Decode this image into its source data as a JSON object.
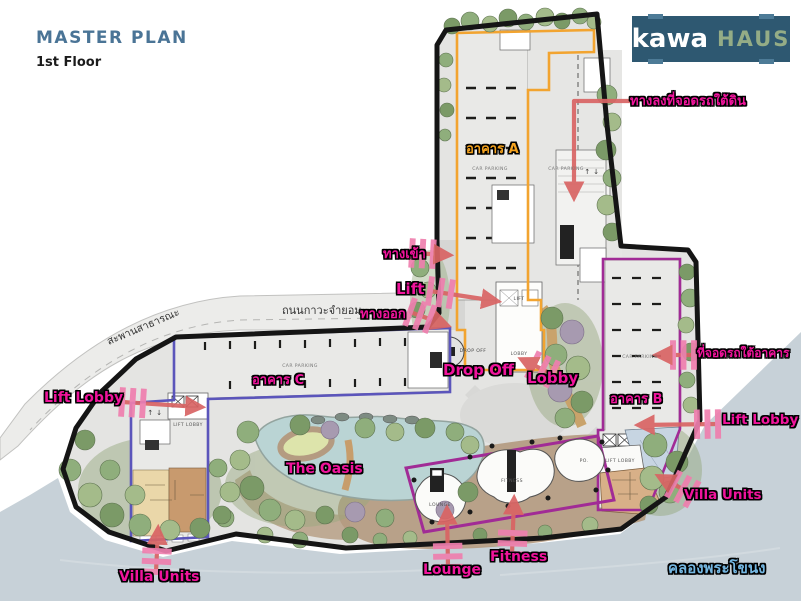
{
  "header": {
    "title": "MASTER PLAN",
    "subtitle": "1st Floor"
  },
  "logo": {
    "word1": "kawa",
    "word2": "HAUS"
  },
  "callouts": {
    "underground_ramp": "ทางลงที่จอดรถใต้ดิน",
    "entrance": "ทางเข้า",
    "lift": "Lift",
    "exit": "ทางออก",
    "drop_off": "Drop Off",
    "lobby": "Lobby",
    "building_a": "อาคาร A",
    "building_b": "อาคาร B",
    "building_c": "อาคาร C",
    "lift_lobby_left": "Lift Lobby",
    "lift_lobby_right": "Lift Lobby",
    "parking_under_building": "ที่จอดรถใต้อาคาร",
    "villa_units_left": "Villa Units",
    "villa_units_right": "Villa Units",
    "the_oasis": "The Oasis",
    "lounge": "Lounge",
    "fitness": "Fitness",
    "canal": "คลองพระโขนง",
    "road": "ถนนกาวะจำยอม",
    "bridge": "สะพานสาธารณะ"
  },
  "plan_texts": {
    "car_parking": "CAR PARKING",
    "drop_off": "DROP OFF",
    "lobby": "LOBBY",
    "lift": "LIFT",
    "lift_lobby": "LIFT LOBBY",
    "lounge": "LOUNGE",
    "fitness": "FITNESS",
    "po": "PO.",
    "updown": "↑ ↓"
  },
  "colors": {
    "accent_magenta": "#f0149c",
    "accent_orange": "#f5a31f",
    "building_b_outline": "#a12b96",
    "building_c_outline": "#5b55bb",
    "arrow_red": "#d96464",
    "canal_text": "#74b7e2",
    "title_blue": "#4a7496",
    "logo_bg": "#2e5871",
    "logo_haus": "#94ac86",
    "water": "#c7d1d8"
  }
}
